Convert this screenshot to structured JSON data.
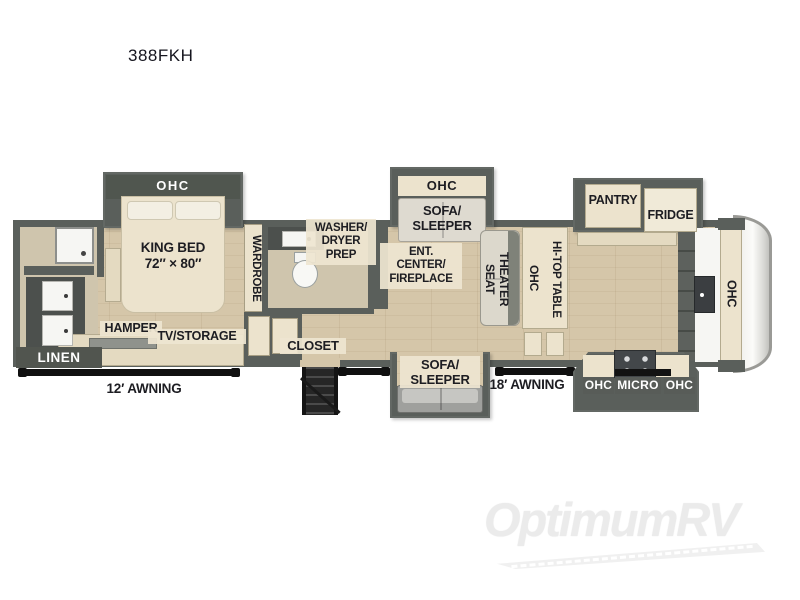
{
  "page": {
    "model": "388FKH"
  },
  "colors": {
    "wall": "#5a5f5b",
    "wall_dark": "#4c504d",
    "floor": "#d5c6a9",
    "floor_bath": "#cfc5ad",
    "cream": "#ece3cd",
    "cream_dark": "#e4dac1",
    "white_fixture": "#f6f6f3",
    "sofa_gray": "#9fa09d",
    "label_text": "#1d1d22",
    "badge_dark": "#51554f",
    "awning": "#101010",
    "watermark_gray": "#ebebeb"
  },
  "plan": {
    "rear_bath": {
      "linen": "LINEN"
    },
    "bedroom": {
      "ohc": "OHC",
      "king_bed": "KING BED\n72″ × 80″",
      "wardrobe": "WARDROBE",
      "hamper": "HAMPER",
      "tv_storage": "TV/STORAGE"
    },
    "mid_bath": {
      "washer_dryer_prep": "WASHER/\nDRYER\nPREP",
      "closet": "CLOSET"
    },
    "living": {
      "ohc": "OHC",
      "sofa_sleeper_top": "SOFA/\nSLEEPER",
      "ent_center": "ENT.\nCENTER/\nFIREPLACE",
      "sofa_sleeper_bottom": "SOFA/\nSLEEPER",
      "theater_seat": "THEATER\nSEAT"
    },
    "dinette": {
      "ohc": "OHC",
      "hi_top_table": "HI-TOP TABLE"
    },
    "kitchen": {
      "pantry": "PANTRY",
      "fridge": "FRIDGE",
      "ohc_front": "OHC",
      "ohc_left": "OHC",
      "micro": "MICRO",
      "ohc_right": "OHC"
    },
    "awnings": {
      "left": "12′ AWNING",
      "right": "18′ AWNING"
    }
  },
  "watermark": {
    "text": "OptimumRV"
  }
}
